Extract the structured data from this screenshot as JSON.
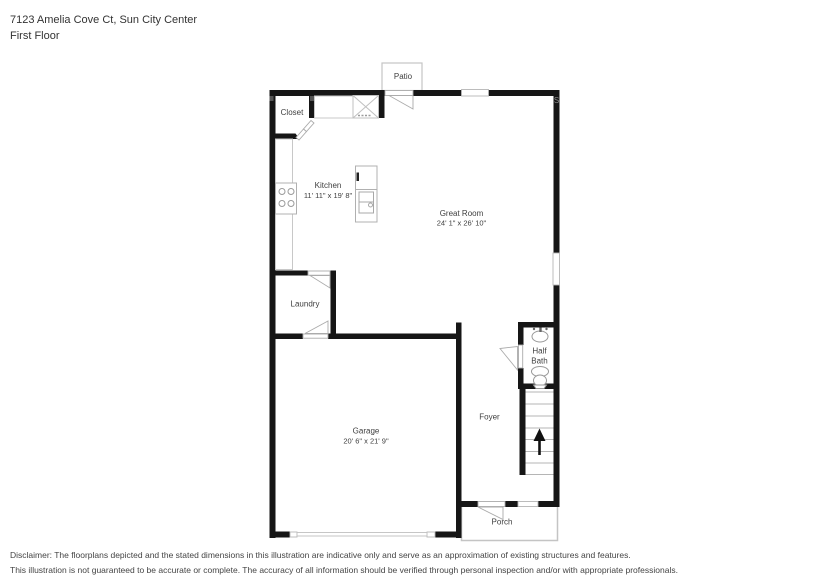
{
  "header": {
    "address_line": "7123 Amelia Cove Ct, Sun City Center",
    "floor_line": "First Floor"
  },
  "floor_plan": {
    "rooms": {
      "patio": {
        "label": "Patio"
      },
      "closet": {
        "label": "Closet"
      },
      "kitchen": {
        "label": "Kitchen",
        "dimensions": "11' 11\" x 19' 8\""
      },
      "great_room": {
        "label": "Great Room",
        "dimensions": "24' 1\" x 26' 10\""
      },
      "laundry": {
        "label": "Laundry"
      },
      "half_bath": {
        "label_line1": "Half",
        "label_line2": "Bath"
      },
      "foyer": {
        "label": "Foyer"
      },
      "garage": {
        "label": "Garage",
        "dimensions": "20' 6\" x 21' 9\""
      },
      "porch": {
        "label": "Porch"
      }
    },
    "corner_mark": "S",
    "fixtures": [
      "stove",
      "kitchen-island-sink",
      "pantry-x-box",
      "bathroom-sink",
      "toilet",
      "stairs-up-arrow",
      "garage-door",
      "front-door",
      "patio-door"
    ],
    "colors": {
      "wall": "#161616",
      "fixture_outline": "#b9b9b9",
      "label_text": "#3e3e3e"
    }
  },
  "disclaimer": {
    "line1": "Disclaimer: The floorplans depicted and the stated dimensions in this illustration are indicative only and serve as an approximation of existing structures and features.",
    "line2": "This illustration is not guaranteed to be accurate or complete. The accuracy of all information should be verified through personal inspection and/or with appropriate professionals."
  }
}
